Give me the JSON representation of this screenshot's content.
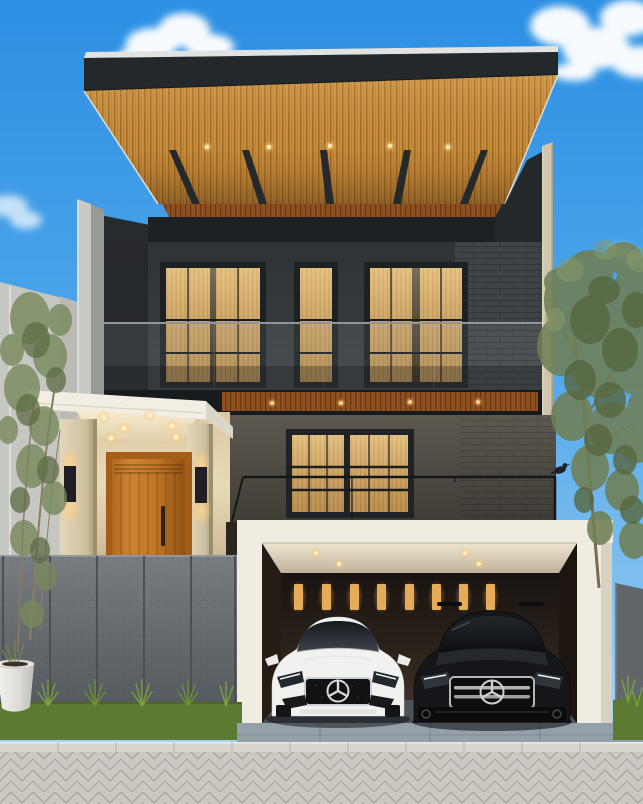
{
  "scene": {
    "type": "architectural exterior render",
    "description": "Modern two-storey house with cantilevered timber-slat roof, dark charcoal upper facade with glass balcony, white entry portico with timber door, and a double garage holding a white sedan and a black SUV, both with three-pointed-star emblems",
    "time_of_day": "day",
    "sky": "blue with scattered white clouds"
  },
  "house": {
    "storeys": 2,
    "roof": {
      "style": "cantilevered flat wing roof",
      "soffit": "vertical timber slats",
      "rafter_count": 5,
      "downlight_count": 5
    },
    "upper_floor": {
      "window_bays": 3,
      "balcony": "frameless glass railing",
      "facade": "dark charcoal panels and brick"
    },
    "lower_floor": {
      "window_bays": 2,
      "railing": "thin black steel",
      "accent_band": "timber slat soffit with 4 downlights"
    },
    "entrance": {
      "door": "orange timber door with vertical planks",
      "canopy_downlights": 6,
      "wall_sconces": 2,
      "pillars": 2
    },
    "garage": {
      "bays": 2,
      "interior_slit_windows": 8,
      "ceiling_downlights": 4
    }
  },
  "vehicles": [
    {
      "position": "left",
      "type": "sedan",
      "color_name": "white",
      "emblem": "three-pointed star"
    },
    {
      "position": "right",
      "type": "suv",
      "color_name": "black",
      "emblem": "three-pointed star"
    }
  ],
  "landscape": {
    "left": "bamboo-style trees, grey panel fence, ornamental grass tufts, round white planter",
    "right": "slender tree and grey side fence",
    "foreground": "paver sidewalk, concrete kerb and blue-grey driveway apron",
    "bird": "small bird perched on the railing end"
  },
  "counts": {
    "fence_panels": 6,
    "grass_tufts": 5,
    "clouds": 4
  },
  "palette": {
    "sky_top": "#2c8fe3",
    "sky_bottom": "#b9ddf6",
    "roof_fascia": "#23282b",
    "roof_wood": "#c8913e",
    "facade_dark": "#383c3e",
    "window_amber": "#d4ad6e",
    "door": "#c07a28",
    "door_frame": "#a55e17",
    "garage_white": "#f0ece2",
    "grass": "#5d7a33",
    "fence": "#6e7377",
    "driveway": "#94a0a8",
    "curb": "#d8d5cd",
    "paver": "#cbc7c1",
    "car_white": "#f1f1ef",
    "car_black": "#141619",
    "chrome": "#c9cccf",
    "tree_green": "#6f7f55"
  }
}
